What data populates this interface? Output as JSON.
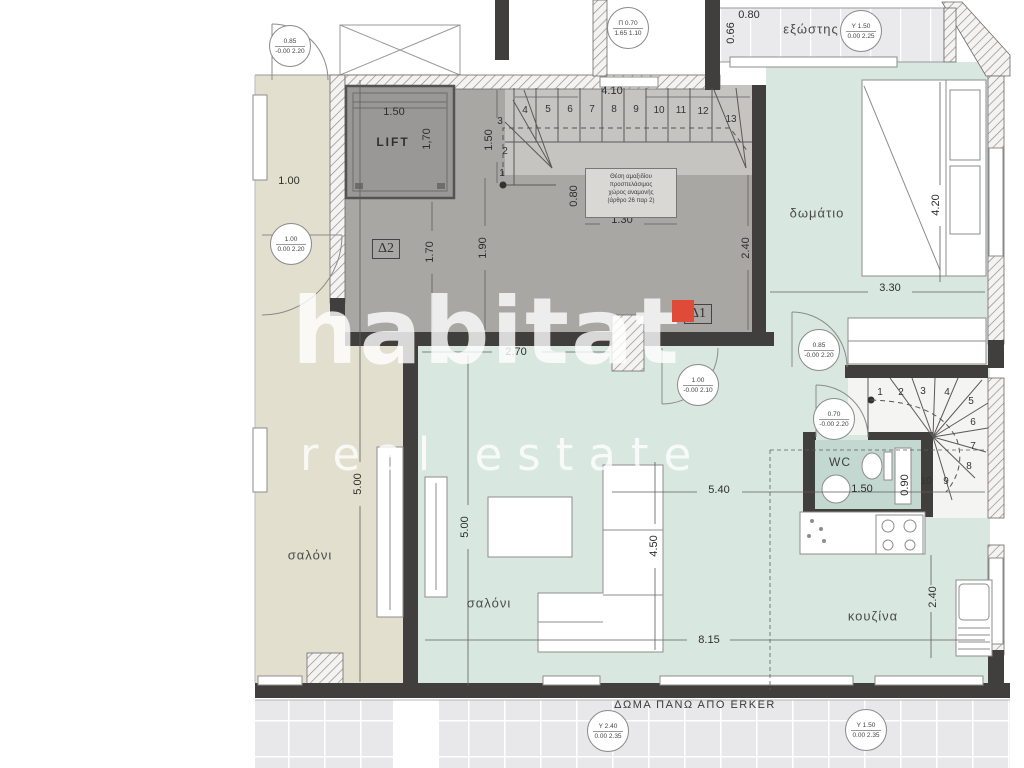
{
  "watermark": {
    "brand": "habitat",
    "tagline": "real estate"
  },
  "labels": {
    "lift": "LIFT",
    "balcony": "εξώστης",
    "bedroom": "δωμάτιο",
    "salon_left": "σαλόνι",
    "salon_main": "σαλόνι",
    "kitchen": "κουζίνα",
    "wc": "WC",
    "d1": "Δ1",
    "d2": "Δ2",
    "bottom_note": "ΔΩΜΑ ΠΑΝΩ ΑΠΟ ERKER"
  },
  "note_box": {
    "line1": "Θέση αμαξιδίου",
    "line2": "προσπελάσιμος",
    "line3": "χώρος αναμονής",
    "line4": "(άρθρο 26 παρ 2)"
  },
  "dimensions": {
    "lift_width": "1.50",
    "lift_depth": "1,70",
    "stair_run": "4.10",
    "stair_winder": "1.50",
    "wait_width": "1.30",
    "wait_depth": "0.80",
    "hall_a": "1.70",
    "hall_b": "1.90",
    "hall_right": "2.40",
    "hall_opening": "2.70",
    "left_wall": "1.00",
    "bedroom_depth": "4.20",
    "bedroom_width": "3.30",
    "salon_left_depth": "5.00",
    "salon_main_depth": "5.00",
    "sofa_span": "4.50",
    "kitchen_span": "5.40",
    "total_span": "8.15",
    "kitchen_depth": "2.40",
    "wc_width": "1.50",
    "wc_depth": "0.90",
    "balcony_width": "0.80",
    "balcony_depth": "0.66"
  },
  "stairs_main": [
    "1",
    "2",
    "3",
    "4",
    "5",
    "6",
    "7",
    "8",
    "9",
    "10",
    "11",
    "12",
    "13"
  ],
  "stairs_upper": [
    "1",
    "2",
    "3",
    "4",
    "5",
    "6",
    "7",
    "8",
    "9",
    "10"
  ],
  "symbols": {
    "door_upper_left": {
      "top": "0.85",
      "bottom": "-0.00 2.20"
    },
    "window_pi": {
      "top": "Π 0.70",
      "bottom": "1.65 1.10"
    },
    "door_left": {
      "top": "1.00",
      "bottom": "0.00 2.20"
    },
    "window_balcony": {
      "top": "Y 1.50",
      "bottom": "0.00 2.25"
    },
    "door_bedroom": {
      "top": "0.85",
      "bottom": "-0.00 2.20"
    },
    "door_entry": {
      "top": "1.00",
      "bottom": "-0.00 2.10"
    },
    "door_wc": {
      "top": "0.70",
      "bottom": "-0.00 2.20"
    },
    "window_terrace_left": {
      "top": "Y 2.40",
      "bottom": "0.00 2.35"
    },
    "window_terrace_right": {
      "top": "Y 1.50",
      "bottom": "0.00 2.35"
    }
  },
  "colors": {
    "wall": "#413f3d",
    "hall_gray": "#a9a7a4",
    "stair_gray": "#c6c4c1",
    "beige_room": "#e3dfce",
    "teal_room": "#d9e7e1",
    "wc_teal": "#c3d8d1",
    "terrace_tile": "#e8e8ea",
    "watermark_red": "#e04a38"
  }
}
